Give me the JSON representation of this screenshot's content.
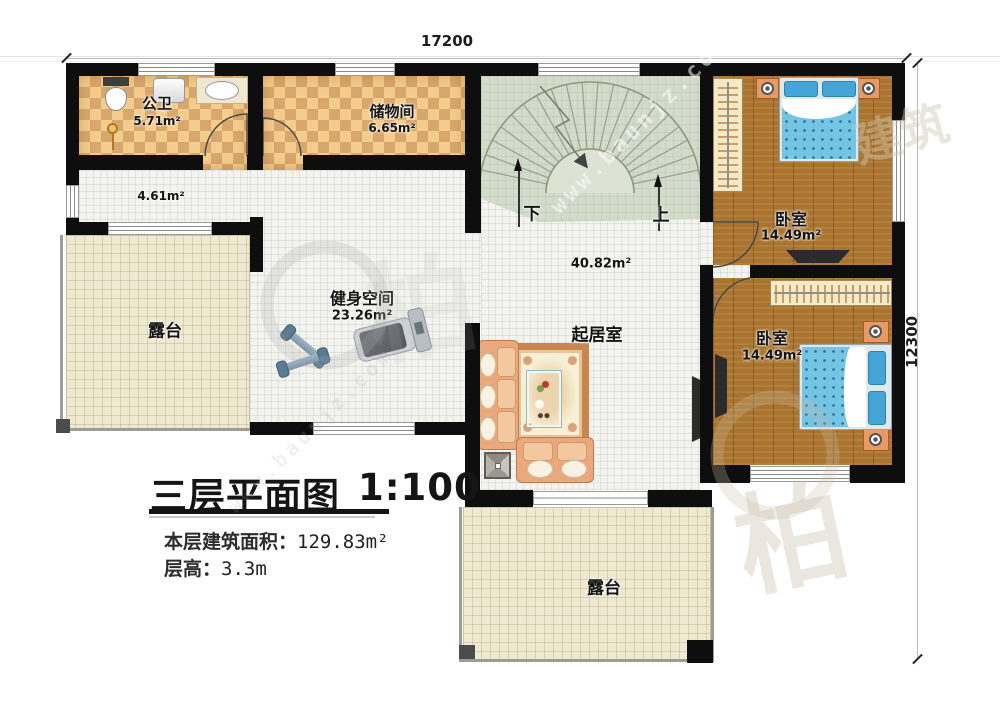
{
  "meta": {
    "plan_title": "三层平面图",
    "plan_scale": "1:100",
    "floor_area_label": "本层建筑面积：",
    "floor_area_value": "129.83m²",
    "floor_height_label": "层高：",
    "floor_height_value": "3.3m"
  },
  "dimensions": {
    "top_width": "17200",
    "right_height": "12300"
  },
  "rooms": {
    "bathroom": {
      "name": "公卫",
      "area": "5.71m²"
    },
    "storage": {
      "name": "储物间",
      "area": "6.65m²"
    },
    "corridor": {
      "area": "4.61m²"
    },
    "stair_hall": {
      "area": "40.82m²"
    },
    "gym": {
      "name": "健身空间",
      "area": "23.26m²"
    },
    "living_room": {
      "name": "起居室"
    },
    "bedroom_top": {
      "name": "卧室",
      "area": "14.49m²"
    },
    "bedroom_bottom": {
      "name": "卧室",
      "area": "14.49m²"
    },
    "terrace_left": {
      "name": "露台"
    },
    "terrace_bottom": {
      "name": "露台"
    }
  },
  "stairs": {
    "down_label": "下",
    "up_label": "上"
  },
  "watermark": {
    "url_text": "www.baunjz.com",
    "brand_text": "建筑",
    "logo_char": "柏"
  },
  "colors": {
    "wall": "#0e0e0e",
    "tile_light": "#f4cd8c",
    "tile_dark": "#d8a76d",
    "floor_white": "#f3f3ef",
    "stair_sage": "#d3dbca",
    "wood": "#a9742f",
    "terrace": "#efe9d2",
    "bed_blue": "#74c4e4",
    "pillow_blue": "#45a5d6",
    "sofa_peach": "#e9a97c",
    "table_teal": "#9fd3d8"
  }
}
